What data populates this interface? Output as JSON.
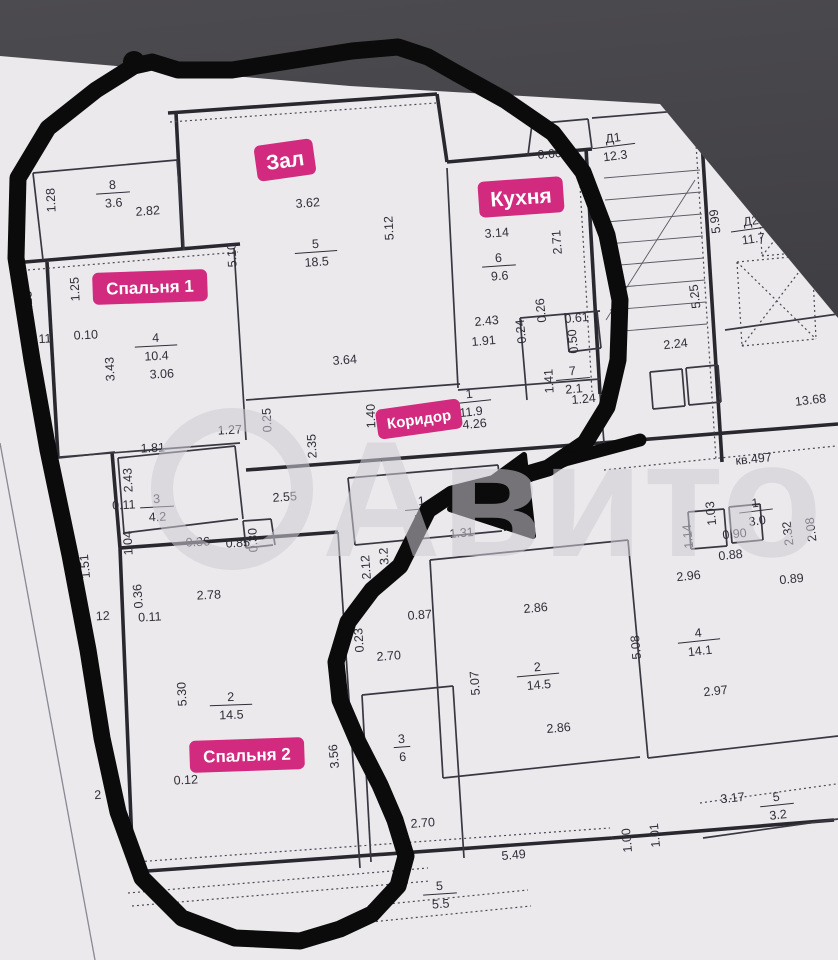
{
  "image": {
    "width": 838,
    "height": 960,
    "kind": "apartment floor plan photo with hand-drawn marker outline"
  },
  "colors": {
    "background_top": "#4c4b4f",
    "background_bottom": "#333236",
    "paper": "#ebe9ec",
    "wall_thick": "#29282f",
    "wall_thin": "#393842",
    "wall_dotted": "#4a4954",
    "hair": "#5b5a63",
    "text": "#2f2e38",
    "chip_pink": "#d12a7e",
    "chip_text": "#ffffff",
    "marker_black": "#0b0b0b",
    "watermark": "rgba(205,203,211,0.55)",
    "fold_line": "#8a8892"
  },
  "sheet": {
    "clip": [
      [
        0,
        56
      ],
      [
        350,
        86
      ],
      [
        660,
        104
      ],
      [
        838,
        318
      ],
      [
        838,
        960
      ],
      [
        0,
        960
      ]
    ],
    "fold_line": [
      0,
      443,
      95,
      960
    ]
  },
  "watermark": {
    "text": "Авито",
    "x": 322,
    "y": 556,
    "font_size": 165,
    "text_length": 500,
    "circle": {
      "cx": 232,
      "cy": 489,
      "r": 70,
      "stroke_width": 22
    }
  },
  "chips": [
    {
      "text": "Зал",
      "x": 285,
      "y": 160,
      "r": -8,
      "fs": 21
    },
    {
      "text": "Кухня",
      "x": 521,
      "y": 197,
      "r": -4,
      "fs": 21
    },
    {
      "text": "Спальня 1",
      "x": 150,
      "y": 287,
      "r": -2,
      "fs": 17
    },
    {
      "text": "Коридор",
      "x": 419,
      "y": 419,
      "r": -8,
      "fs": 15
    },
    {
      "text": "Спальня 2",
      "x": 247,
      "y": 755,
      "r": -2,
      "fs": 17
    }
  ],
  "room_fractions": [
    {
      "a": "8",
      "b": "3.6",
      "x": 113,
      "y": 193,
      "r": -4
    },
    {
      "a": "5",
      "b": "18.5",
      "x": 316,
      "y": 252,
      "r": -4
    },
    {
      "a": "6",
      "b": "9.6",
      "x": 499,
      "y": 266,
      "r": -4
    },
    {
      "a": "4",
      "b": "10.4",
      "x": 156,
      "y": 346,
      "r": -3
    },
    {
      "a": "1",
      "b": "11.9",
      "x": 470,
      "y": 402,
      "r": -6
    },
    {
      "a": "7",
      "b": "2.1",
      "x": 573,
      "y": 379,
      "r": -5
    },
    {
      "a": "3",
      "b": "4.2",
      "x": 157,
      "y": 507,
      "r": -3
    },
    {
      "a": "2",
      "b": "14.5",
      "x": 231,
      "y": 705,
      "r": -2
    },
    {
      "a": "1",
      "b": "5.2",
      "x": 422,
      "y": 509,
      "r": -5
    },
    {
      "a": "2",
      "b": "14.5",
      "x": 538,
      "y": 675,
      "r": -5
    },
    {
      "a": "4",
      "b": "14.1",
      "x": 699,
      "y": 641,
      "r": -6
    },
    {
      "a": "3",
      "b": "6",
      "x": 402,
      "y": 747,
      "r": -4
    },
    {
      "a": "5",
      "b": "3.2",
      "x": 777,
      "y": 805,
      "r": -6
    },
    {
      "a": "5",
      "b": "5.5",
      "x": 440,
      "y": 894,
      "r": -4
    },
    {
      "a": "1",
      "b": "3.0",
      "x": 756,
      "y": 511,
      "r": -7
    },
    {
      "a": "Д1",
      "b": "12.3",
      "x": 614,
      "y": 146,
      "r": -7
    },
    {
      "a": "Д2",
      "b": "11.7",
      "x": 752,
      "y": 229,
      "r": -8
    }
  ],
  "dimension_labels": [
    [
      "1.28",
      55,
      200,
      -93
    ],
    [
      "2.82",
      148,
      215,
      -4
    ],
    [
      "3.62",
      308,
      207,
      -4
    ],
    [
      "5.10",
      236,
      255,
      -93
    ],
    [
      "5.12",
      393,
      228,
      -93
    ],
    [
      "0.60",
      550,
      158,
      -5
    ],
    [
      "3.14",
      497,
      237,
      -4
    ],
    [
      "2.71",
      561,
      242,
      -94
    ],
    [
      "пом.2д",
      743,
      124,
      -8
    ],
    [
      "4.0",
      829,
      121,
      -8
    ],
    [
      "2",
      835,
      139,
      -8
    ],
    [
      "5.99",
      719,
      221,
      -97
    ],
    [
      "5.25",
      699,
      296,
      -97
    ],
    [
      "1.23",
      32,
      303,
      -93
    ],
    [
      "1.25",
      79,
      289,
      -93
    ],
    [
      "0.11",
      40,
      343,
      -3
    ],
    [
      "0.10",
      86,
      339,
      -3
    ],
    [
      "3.43",
      114,
      369,
      -93
    ],
    [
      "3.06",
      162,
      378,
      -3
    ],
    [
      "4.53",
      39,
      383,
      -93
    ],
    [
      "3.64",
      345,
      364,
      -4
    ],
    [
      "2.43",
      487,
      325,
      -5
    ],
    [
      "1.91",
      484,
      345,
      -5
    ],
    [
      "4.26",
      475,
      428,
      -5
    ],
    [
      "1.40",
      375,
      416,
      -92
    ],
    [
      "2.35",
      316,
      446,
      -93
    ],
    [
      "0.25",
      271,
      420,
      -93
    ],
    [
      "0.26",
      545,
      310,
      -96
    ],
    [
      "0.24",
      525,
      331,
      -96
    ],
    [
      "0.61",
      577,
      322,
      -5
    ],
    [
      "0.50",
      577,
      341,
      -96
    ],
    [
      "1.41",
      553,
      381,
      -93
    ],
    [
      "1.24",
      584,
      403,
      -5
    ],
    [
      "2.24",
      676,
      348,
      -6
    ],
    [
      "13.68",
      811,
      404,
      -7
    ],
    [
      "кв.497",
      754,
      463,
      -6
    ],
    [
      "1.81",
      153,
      452,
      -3
    ],
    [
      "2.43",
      132,
      480,
      -93
    ],
    [
      "1.27",
      230,
      434,
      -3
    ],
    [
      "0.11",
      124,
      509,
      -3
    ],
    [
      "1.04",
      132,
      543,
      -93
    ],
    [
      "2.55",
      285,
      501,
      -4
    ],
    [
      "0.36",
      198,
      546,
      -3
    ],
    [
      "0.85",
      238,
      547,
      -3
    ],
    [
      "0.30",
      257,
      540,
      -93
    ],
    [
      "1.51",
      89,
      566,
      -95
    ],
    [
      "12",
      103,
      620,
      -3
    ],
    [
      "2.78",
      209,
      599,
      -3
    ],
    [
      "0.11",
      150,
      621,
      -3
    ],
    [
      "0.36",
      142,
      596,
      -94
    ],
    [
      "5.30",
      186,
      694,
      -93
    ],
    [
      "0.12",
      186,
      784,
      -3
    ],
    [
      "3.56",
      338,
      756,
      -95
    ],
    [
      "2.12",
      370,
      567,
      -94
    ],
    [
      "3.2",
      388,
      556,
      -94
    ],
    [
      "0.87",
      420,
      619,
      -4
    ],
    [
      "0.23",
      363,
      640,
      -94
    ],
    [
      "2.70",
      389,
      660,
      -4
    ],
    [
      "1.31",
      462,
      537,
      -5
    ],
    [
      "2.86",
      536,
      612,
      -5
    ],
    [
      "5.07",
      479,
      683,
      -94
    ],
    [
      "5.08",
      640,
      647,
      -95
    ],
    [
      "1.14",
      692,
      536,
      -96
    ],
    [
      "1.03",
      715,
      513,
      -96
    ],
    [
      "0.90",
      735,
      538,
      -6
    ],
    [
      "0.88",
      731,
      559,
      -6
    ],
    [
      "2.32",
      792,
      533,
      -97
    ],
    [
      "2.08",
      815,
      529,
      -97
    ],
    [
      "0.89",
      792,
      583,
      -6
    ],
    [
      "2.96",
      689,
      580,
      -6
    ],
    [
      "2.97",
      716,
      695,
      -6
    ],
    [
      "3.17",
      733,
      802,
      -6
    ],
    [
      "1.00",
      631,
      840,
      -95
    ],
    [
      "1.01",
      659,
      835,
      -95
    ],
    [
      "2.86",
      559,
      732,
      -5
    ],
    [
      "2.70",
      423,
      827,
      -4
    ],
    [
      "5.49",
      514,
      859,
      -5
    ],
    [
      "2",
      98,
      799,
      -3
    ]
  ],
  "walls": {
    "thick": [
      [
        168,
        113,
        437,
        94
      ],
      [
        176,
        113,
        183,
        250
      ],
      [
        25,
        262,
        240,
        244
      ],
      [
        47,
        262,
        58,
        458
      ],
      [
        437,
        94,
        447,
        162
      ],
      [
        447,
        162,
        592,
        149
      ],
      [
        586,
        148,
        600,
        394
      ],
      [
        112,
        452,
        120,
        548
      ],
      [
        120,
        548,
        338,
        532
      ],
      [
        120,
        548,
        133,
        870
      ],
      [
        133,
        872,
        612,
        838
      ],
      [
        612,
        838,
        834,
        820
      ],
      [
        246,
        470,
        600,
        443
      ],
      [
        600,
        443,
        838,
        424
      ],
      [
        700,
        110,
        722,
        462
      ]
    ],
    "normal": [
      [
        33,
        173,
        177,
        160
      ],
      [
        33,
        173,
        43,
        260
      ],
      [
        177,
        160,
        184,
        250
      ],
      [
        47,
        458,
        240,
        443
      ],
      [
        234,
        248,
        246,
        440
      ],
      [
        447,
        168,
        458,
        388
      ],
      [
        246,
        400,
        460,
        384
      ],
      [
        458,
        390,
        600,
        379
      ],
      [
        118,
        458,
        235,
        446
      ],
      [
        118,
        458,
        124,
        533
      ],
      [
        124,
        533,
        238,
        519
      ],
      [
        235,
        446,
        243,
        519
      ],
      [
        243,
        521,
        271,
        519
      ],
      [
        243,
        521,
        246,
        548
      ],
      [
        246,
        548,
        273,
        545
      ],
      [
        271,
        519,
        275,
        545
      ],
      [
        338,
        532,
        360,
        868
      ],
      [
        520,
        318,
        600,
        311
      ],
      [
        520,
        318,
        527,
        400
      ],
      [
        565,
        313,
        569,
        352
      ],
      [
        569,
        352,
        601,
        348
      ],
      [
        597,
        311,
        601,
        348
      ],
      [
        348,
        478,
        498,
        465
      ],
      [
        348,
        478,
        355,
        545
      ],
      [
        355,
        545,
        502,
        531
      ],
      [
        498,
        465,
        505,
        531
      ],
      [
        592,
        118,
        838,
        98
      ],
      [
        722,
        145,
        838,
        131
      ],
      [
        725,
        330,
        838,
        314
      ],
      [
        650,
        372,
        682,
        369
      ],
      [
        650,
        372,
        653,
        409
      ],
      [
        653,
        409,
        685,
        406
      ],
      [
        682,
        369,
        685,
        406
      ],
      [
        686,
        368,
        718,
        365
      ],
      [
        686,
        368,
        689,
        405
      ],
      [
        689,
        405,
        721,
        402
      ],
      [
        718,
        365,
        721,
        402
      ],
      [
        430,
        560,
        628,
        540
      ],
      [
        430,
        560,
        443,
        778
      ],
      [
        443,
        778,
        640,
        757
      ],
      [
        628,
        540,
        648,
        758
      ],
      [
        362,
        695,
        453,
        686
      ],
      [
        362,
        695,
        371,
        862
      ],
      [
        453,
        686,
        464,
        858
      ],
      [
        688,
        512,
        724,
        509
      ],
      [
        688,
        512,
        691,
        549
      ],
      [
        691,
        549,
        727,
        546
      ],
      [
        724,
        509,
        727,
        546
      ],
      [
        729,
        507,
        760,
        504
      ],
      [
        729,
        507,
        732,
        543
      ],
      [
        732,
        543,
        763,
        540
      ],
      [
        760,
        504,
        763,
        540
      ],
      [
        648,
        758,
        838,
        736
      ],
      [
        703,
        838,
        838,
        819
      ],
      [
        58,
        458,
        115,
        452
      ],
      [
        600,
        394,
        604,
        443
      ],
      [
        528,
        155,
        532,
        124
      ],
      [
        532,
        124,
        588,
        119
      ],
      [
        588,
        119,
        592,
        149
      ]
    ],
    "dotted": [
      [
        170,
        122,
        436,
        103
      ],
      [
        28,
        270,
        238,
        252
      ],
      [
        135,
        862,
        610,
        828
      ],
      [
        578,
        151,
        592,
        392
      ],
      [
        694,
        112,
        716,
        460
      ],
      [
        128,
        893,
        428,
        868
      ],
      [
        132,
        906,
        430,
        881
      ],
      [
        368,
        906,
        528,
        890
      ],
      [
        371,
        922,
        531,
        906
      ],
      [
        700,
        803,
        836,
        784
      ],
      [
        604,
        470,
        836,
        446
      ],
      [
        757,
        172,
        834,
        165
      ],
      [
        757,
        172,
        762,
        256
      ],
      [
        762,
        256,
        838,
        249
      ],
      [
        834,
        165,
        838,
        249
      ],
      [
        757,
        172,
        838,
        249
      ],
      [
        762,
        256,
        834,
        165
      ],
      [
        737,
        262,
        812,
        255
      ],
      [
        737,
        262,
        742,
        346
      ],
      [
        742,
        346,
        816,
        339
      ],
      [
        812,
        255,
        816,
        339
      ],
      [
        737,
        262,
        816,
        339
      ],
      [
        742,
        346,
        812,
        255
      ]
    ],
    "hair": [
      [
        604,
        178,
        700,
        170
      ],
      [
        605,
        200,
        701,
        192
      ],
      [
        606,
        222,
        702,
        214
      ],
      [
        607,
        244,
        703,
        236
      ],
      [
        608,
        266,
        704,
        258
      ],
      [
        609,
        288,
        705,
        280
      ],
      [
        610,
        310,
        706,
        302
      ],
      [
        611,
        332,
        707,
        324
      ],
      [
        606,
        320,
        695,
        180
      ]
    ]
  },
  "marker_outline": {
    "stroke_width": 17,
    "points": [
      [
        134,
        66
      ],
      [
        96,
        90
      ],
      [
        48,
        128
      ],
      [
        18,
        178
      ],
      [
        16,
        258
      ],
      [
        32,
        360
      ],
      [
        48,
        450
      ],
      [
        70,
        555
      ],
      [
        88,
        650
      ],
      [
        102,
        738
      ],
      [
        118,
        812
      ],
      [
        142,
        878
      ],
      [
        182,
        918
      ],
      [
        235,
        938
      ],
      [
        300,
        941
      ],
      [
        340,
        929
      ],
      [
        372,
        914
      ],
      [
        398,
        886
      ],
      [
        406,
        856
      ],
      [
        395,
        820
      ],
      [
        380,
        785
      ],
      [
        358,
        742
      ],
      [
        340,
        700
      ],
      [
        336,
        662
      ],
      [
        348,
        622
      ],
      [
        372,
        590
      ],
      [
        400,
        566
      ],
      [
        414,
        538
      ],
      [
        428,
        510
      ],
      [
        452,
        494
      ],
      [
        500,
        482
      ],
      [
        548,
        468
      ],
      [
        585,
        443
      ],
      [
        607,
        407
      ],
      [
        618,
        360
      ],
      [
        620,
        300
      ],
      [
        607,
        235
      ],
      [
        583,
        172
      ],
      [
        553,
        133
      ],
      [
        505,
        100
      ],
      [
        458,
        74
      ],
      [
        428,
        57
      ],
      [
        398,
        47
      ],
      [
        352,
        51
      ],
      [
        295,
        60
      ],
      [
        232,
        70
      ],
      [
        178,
        70
      ],
      [
        152,
        62
      ]
    ],
    "nub": {
      "cx": 134,
      "cy": 62,
      "r": 11
    }
  },
  "marker_arrow": {
    "shaft": [
      [
        640,
        440
      ],
      [
        565,
        460
      ],
      [
        492,
        492
      ]
    ],
    "shaft_width": 13,
    "head": [
      [
        450,
        509
      ],
      [
        524,
        455
      ],
      [
        533,
        536
      ]
    ]
  }
}
